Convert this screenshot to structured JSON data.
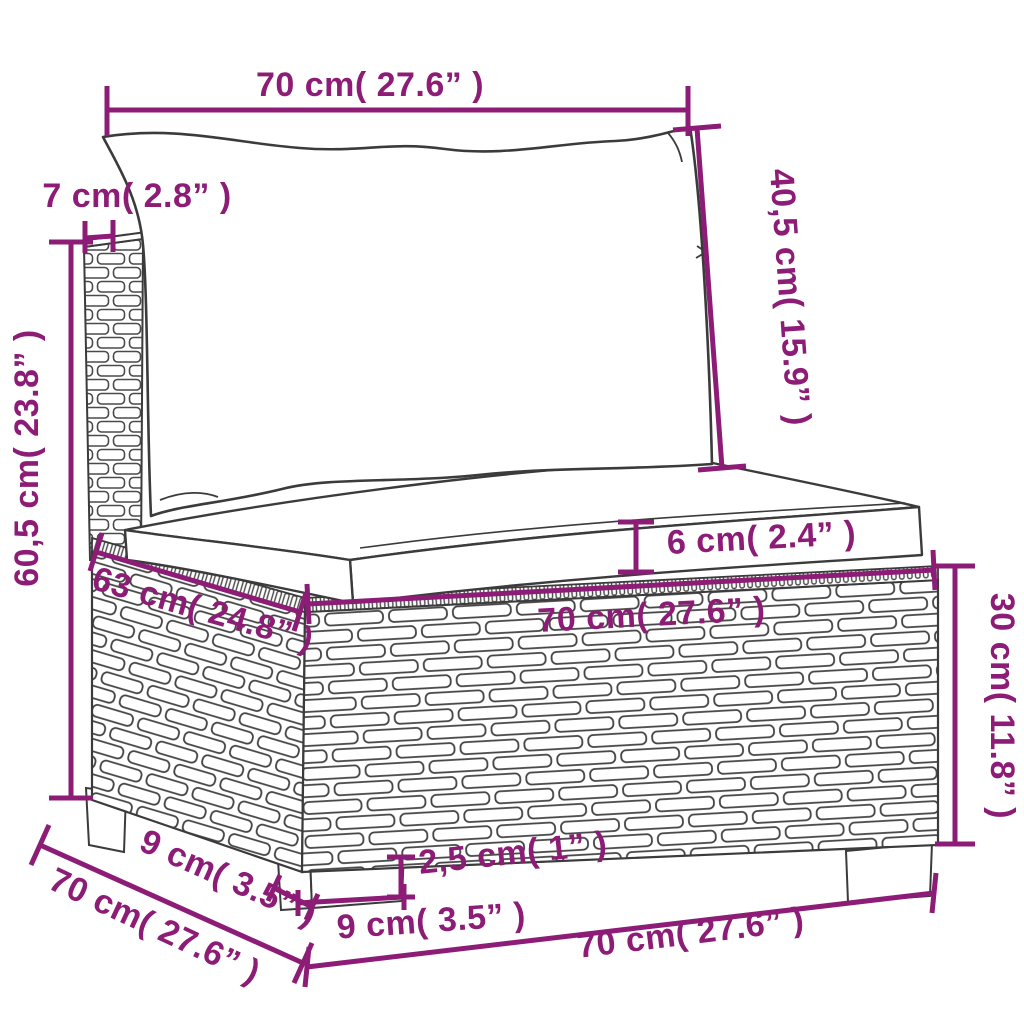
{
  "figure_type": "product-dimension-diagram",
  "colors": {
    "dimension_annotation": "#8d1c76",
    "line_art": "#3b3b3b",
    "background": "#ffffff"
  },
  "dimensions": {
    "top_width": {
      "cm": "70",
      "in": "27.6",
      "label": "70 cm( 27.6” )"
    },
    "back_cushion_height": {
      "cm": "40,5",
      "in": "15.9",
      "label": "40,5 cm( 15.9” )"
    },
    "back_panel_thickness": {
      "cm": "7",
      "in": "2.8",
      "label": "7 cm( 2.8” )"
    },
    "total_height": {
      "cm": "60,5",
      "in": "23.8",
      "label": "60,5 cm( 23.8” )"
    },
    "seat_depth": {
      "cm": "63",
      "in": "24.8",
      "label": "63 cm( 24.8” )"
    },
    "seat_cushion_thickness": {
      "cm": "6",
      "in": "2.4",
      "label": "6 cm( 2.4” )"
    },
    "seat_width": {
      "cm": "70",
      "in": "27.6",
      "label": "70 cm( 27.6” )"
    },
    "base_height": {
      "cm": "30",
      "in": "11.8",
      "label": "30 cm( 11.8” )"
    },
    "leg_height": {
      "cm": "2,5",
      "in": "1",
      "label": "2,5 cm( 1” )"
    },
    "leg_width": {
      "cm": "9",
      "in": "3.5",
      "label": "9 cm( 3.5” )"
    },
    "leg_depth": {
      "cm": "9",
      "in": "3.5",
      "label": "9 cm( 3.5” )"
    },
    "total_depth": {
      "cm": "70",
      "in": "27.6",
      "label": "70 cm( 27.6” )"
    },
    "total_width": {
      "cm": "70",
      "in": "27.6",
      "label": "70 cm( 27.6” )"
    }
  }
}
